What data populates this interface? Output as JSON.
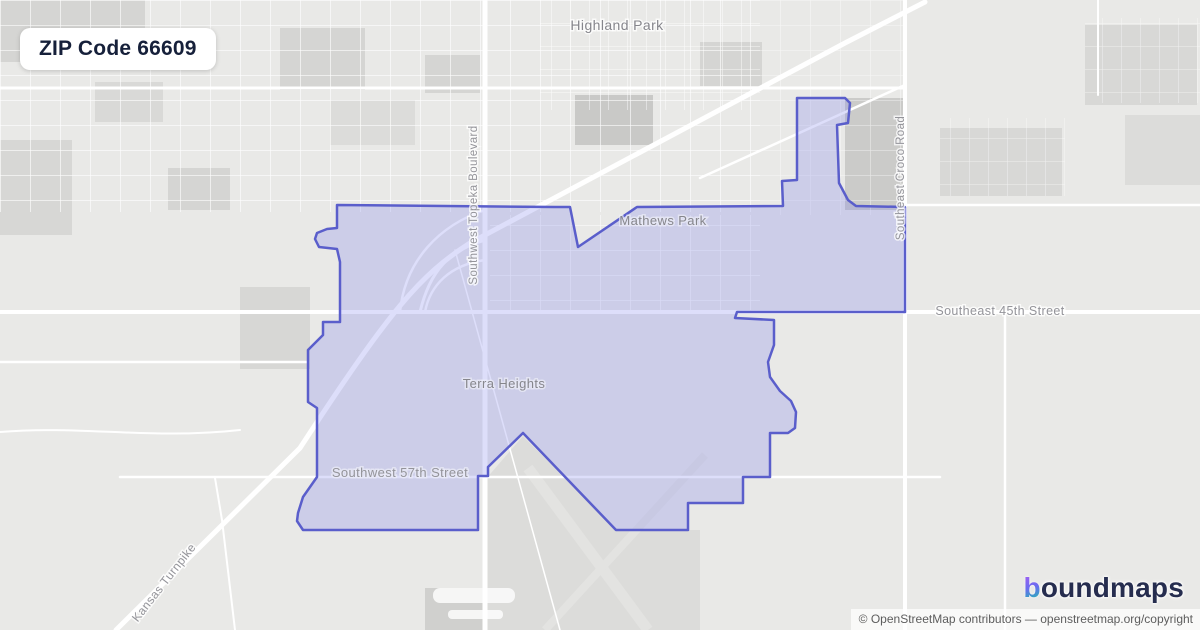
{
  "badge": {
    "title": "ZIP Code 66609"
  },
  "map": {
    "place_labels": [
      {
        "id": "highland-park",
        "text": "Highland Park"
      },
      {
        "id": "mathews-park",
        "text": "Mathews Park"
      },
      {
        "id": "terra-heights",
        "text": "Terra Heights"
      }
    ],
    "road_labels": [
      {
        "id": "topeka-boulevard",
        "text": "Southwest Topeka Boulevard"
      },
      {
        "id": "croco-road",
        "text": "Southeast Croco Road"
      },
      {
        "id": "45th-street",
        "text": "Southeast 45th Street"
      },
      {
        "id": "57th-street",
        "text": "Southwest 57th Street"
      },
      {
        "id": "kansas-turnpike",
        "text": "Kansas Turnpike"
      }
    ],
    "zip_boundary_points": "337,205 555,207 570,207 578,247 637,207 783,206 782,181 797,180 797,98 845,98 850,103 848,123 837,125 839,183 848,200 856,206 905,207 905,312 737,312 735,318 774,320 774,345 768,362 770,377 780,391 791,401 796,412 795,428 788,433 770,433 770,477 743,477 743,503 688,503 688,530 616,530 523,433 488,467 488,476 478,476 478,530 303,530 297,521 298,513 303,497 317,477 317,408 308,402 308,350 323,335 323,322 340,322 340,262 337,249 319,247 315,239 317,233 327,229 337,228",
    "colors": {
      "boundary_stroke": "#5a5ecb",
      "boundary_fill": "rgba(124,128,234,0.26)",
      "map_base": "#e9e9e7",
      "label_gray": "#94949a"
    }
  },
  "brand": {
    "name": "boundmaps",
    "first_letter": "b",
    "rest": "oundmaps"
  },
  "attribution": {
    "text": "© OpenStreetMap contributors — openstreetmap.org/copyright"
  }
}
